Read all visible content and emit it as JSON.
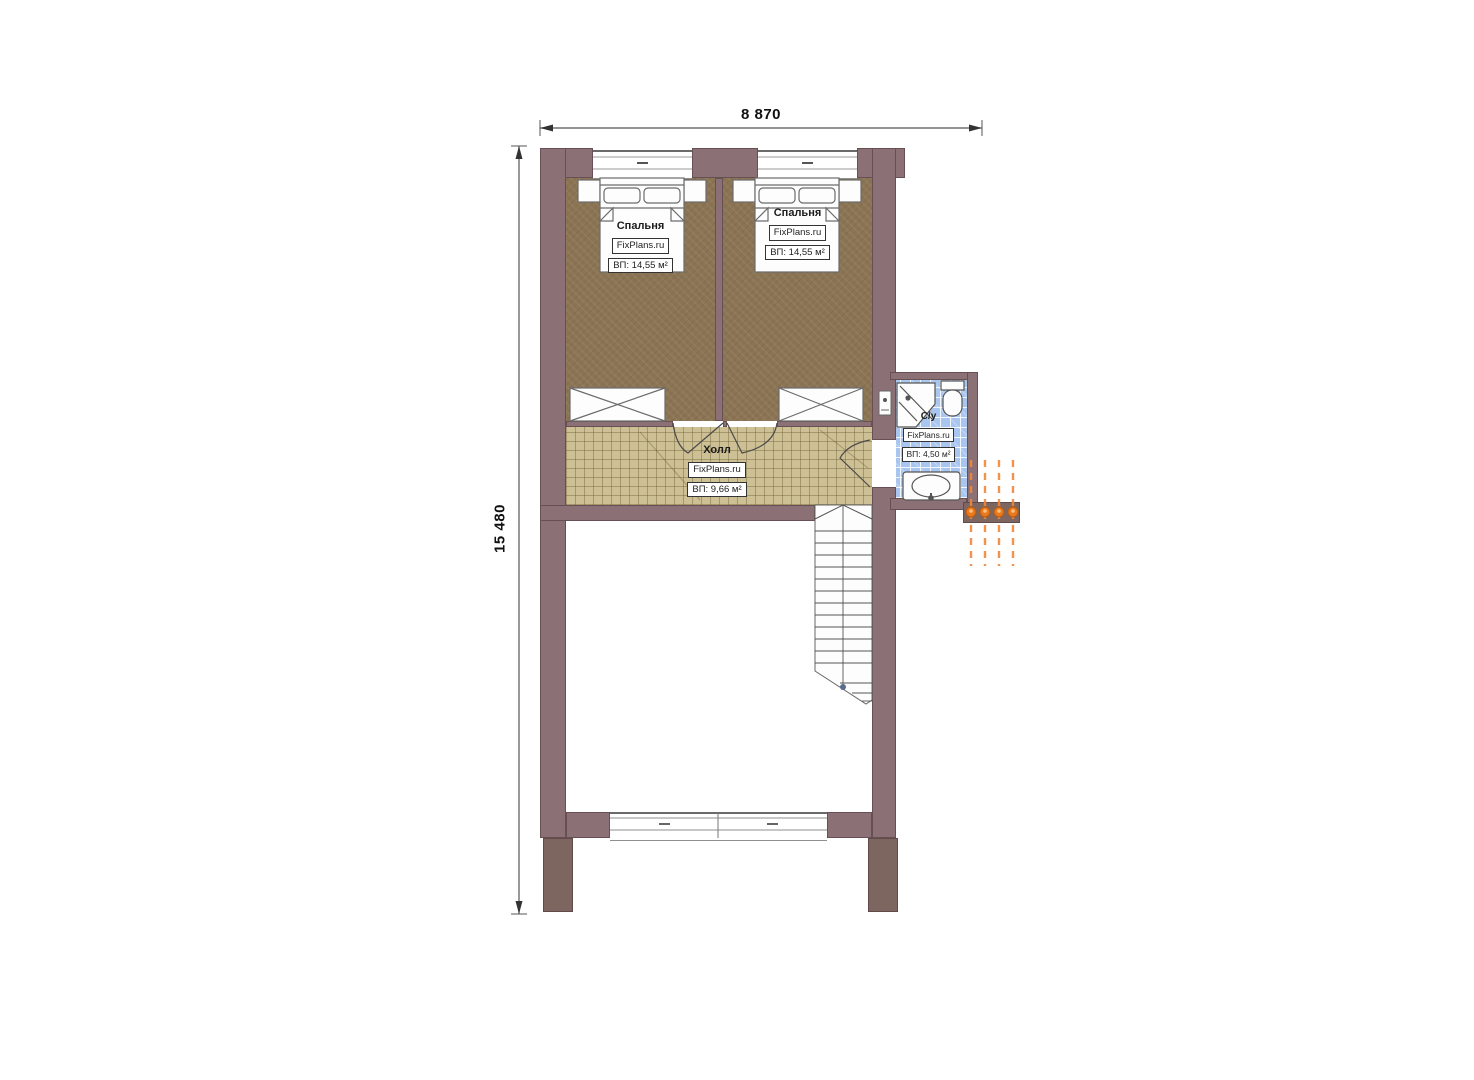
{
  "dimensions": {
    "width_label": "8 870",
    "height_label": "15 480"
  },
  "rooms": {
    "bedroom_left": {
      "name": "Спальня",
      "brand": "FixPlans.ru",
      "area": "ВП: 14,55 м²"
    },
    "bedroom_right": {
      "name": "Спальня",
      "brand": "FixPlans.ru",
      "area": "ВП: 14,55 м²"
    },
    "hall": {
      "name": "Холл",
      "brand": "FixPlans.ru",
      "area": "ВП: 9,66 м²"
    },
    "bathroom": {
      "name": "С/у",
      "brand": "FixPlans.ru",
      "area": "ВП: 4,50 м²"
    }
  },
  "colors": {
    "wall": "#8b7176",
    "wall_dark": "#7d6660",
    "carpet": "#8b7453",
    "hall_tile": "#cdc094",
    "bath_tile": "#a8c6ef",
    "orange": "#e8791f",
    "line": "#555555"
  }
}
